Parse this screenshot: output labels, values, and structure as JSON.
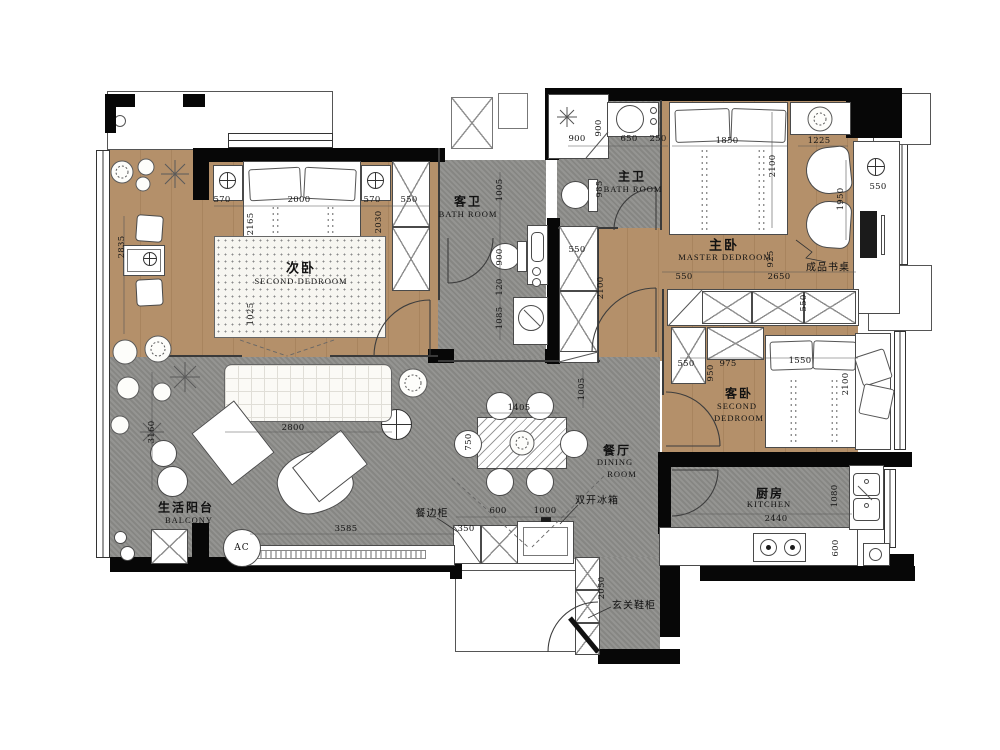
{
  "rooms": {
    "second_bedroom": {
      "cn": "次卧",
      "en": "SECOND DEDROOM"
    },
    "guest_bath": {
      "cn": "客卫",
      "en": "BATH ROOM"
    },
    "master_bath": {
      "cn": "主卫",
      "en": "BATH ROOM"
    },
    "master_bedroom": {
      "cn": "主卧",
      "en": "MASTER DEDROOM"
    },
    "guest_bedroom": {
      "cn": "客卧",
      "en1": "SECOND",
      "en2": "DEDROOM"
    },
    "dining": {
      "cn": "餐厅",
      "en1": "DINING",
      "en2": "ROOM"
    },
    "kitchen": {
      "cn": "厨房",
      "en": "KITCHEN"
    },
    "balcony": {
      "cn": "生活阳台",
      "en": "BALCONY"
    }
  },
  "annotations": {
    "desk": "成品书桌",
    "sideboard": "餐边柜",
    "fridge": "双开冰箱",
    "shoe_cabinet": "玄关鞋柜",
    "ac": "AC"
  },
  "colors": {
    "wood": "#b4906a",
    "floor_gray": "#8e8e8b",
    "wall": "#070707"
  },
  "dims": {
    "d570l": "570",
    "d2000": "2000",
    "d570r": "570",
    "d550w": "550",
    "d2165": "2165",
    "d2030": "2030",
    "d1025": "1025",
    "d2835": "2835",
    "d3160": "3160",
    "d1005c": "1005",
    "d900t": "900",
    "d120": "120",
    "d1085": "1085",
    "d900s": "900",
    "d900sv": "900",
    "d650": "650",
    "d250": "250",
    "d985": "985",
    "d550wd": "550",
    "d2100wd": "2100",
    "d1850": "1850",
    "d1225": "1225",
    "d2100mb": "2100",
    "d1950": "1950",
    "d550desk": "550",
    "d925": "925",
    "d550mb": "550",
    "d2650": "2650",
    "d550gt": "550",
    "d550gl": "550",
    "d975": "975",
    "d1550": "1550",
    "d950": "950",
    "d2100gb": "2100",
    "d2440": "2440",
    "d1080": "1080",
    "d600k": "600",
    "d1005d": "1005",
    "d750": "750",
    "d1405": "1405",
    "d600s": "600",
    "d1000": "1000",
    "d350": "350",
    "d2050": "2050",
    "d2800": "2800",
    "d3585": "3585"
  }
}
